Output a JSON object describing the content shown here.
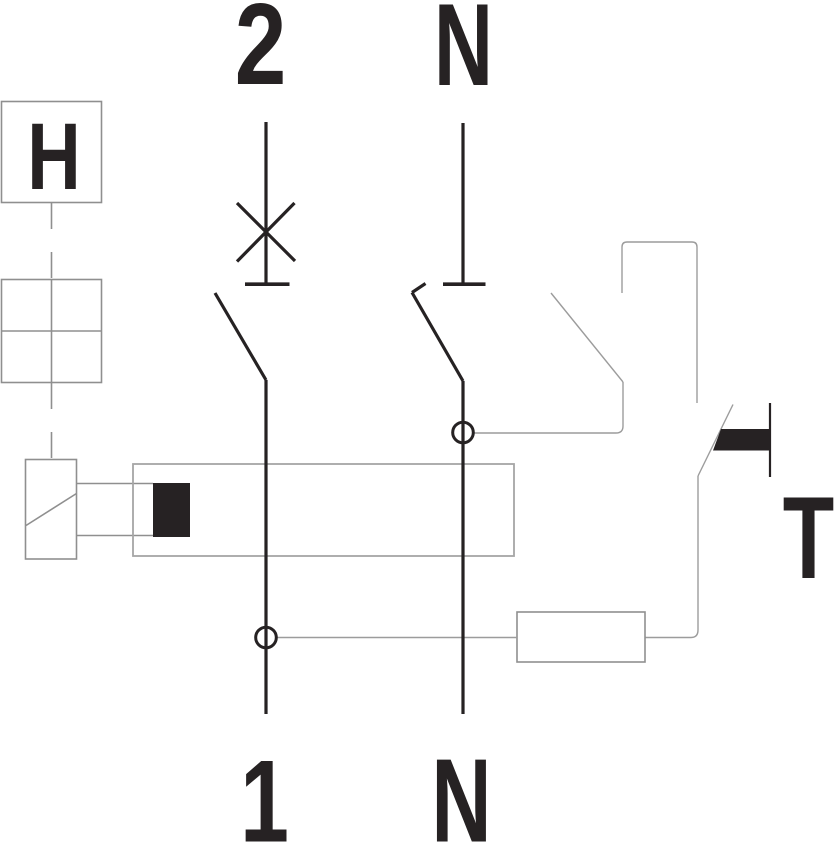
{
  "diagram": {
    "kind": "residual-current-device schematic",
    "terminals": {
      "top_line": "2",
      "top_neutral": "N",
      "bottom_line": "1",
      "bottom_neutral": "N"
    },
    "component_labels": {
      "indicator": "H",
      "test_button": "T"
    },
    "colors": {
      "dark": "#262223",
      "box": "#8f8f8f",
      "thin": "#9c9c9c",
      "toroid": "#a6a6a6",
      "background": "#ffffff"
    }
  }
}
